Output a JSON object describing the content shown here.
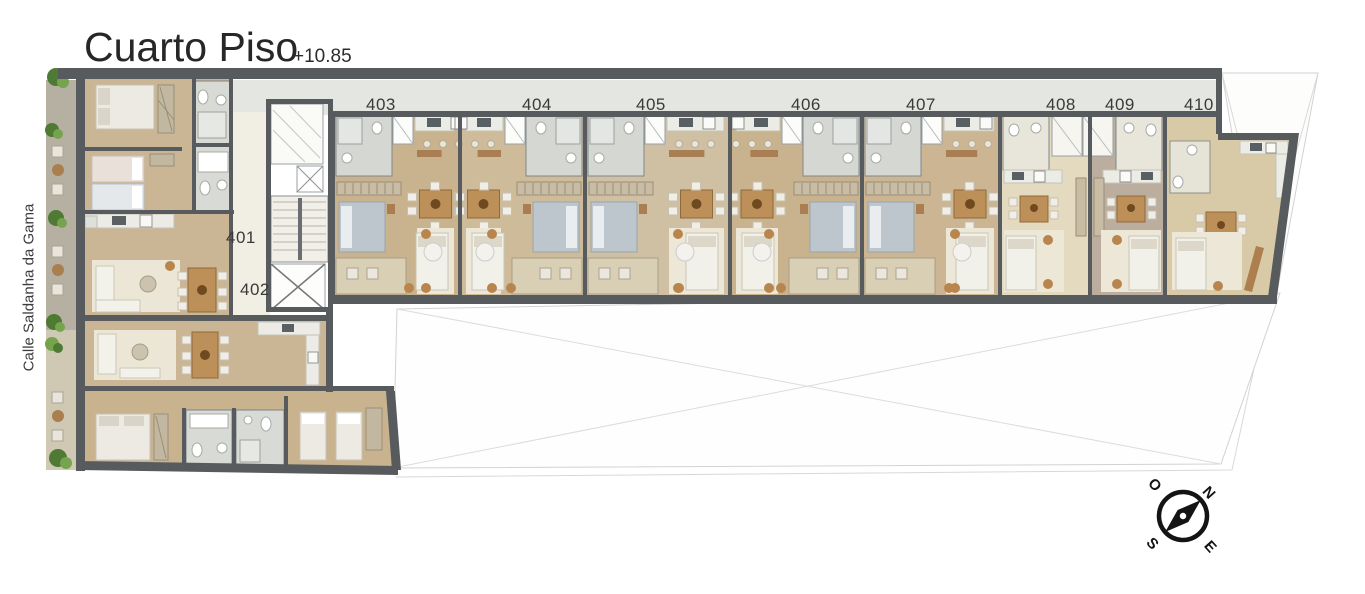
{
  "header": {
    "title": "Cuarto Piso",
    "elevation": "+10.85"
  },
  "street": {
    "label": "Calle Saldanha da Gama"
  },
  "units": [
    {
      "label": "401"
    },
    {
      "label": "402"
    },
    {
      "label": "403"
    },
    {
      "label": "404"
    },
    {
      "label": "405"
    },
    {
      "label": "406"
    },
    {
      "label": "407"
    },
    {
      "label": "408"
    },
    {
      "label": "409"
    },
    {
      "label": "410"
    }
  ],
  "compass": {
    "north": "N",
    "east": "E",
    "south": "S",
    "west": "O"
  },
  "colors": {
    "wall": "#575b5e",
    "wood_floor": "#c9b28e",
    "corridor": "#e4e7e1",
    "core_corridor": "#f1eee4",
    "bath": "#d5d8d2",
    "rug": "#ede7d7",
    "accent_wood": "#a87e52",
    "plant_green": "#4e7a33",
    "void_line": "#d2d2d2"
  }
}
